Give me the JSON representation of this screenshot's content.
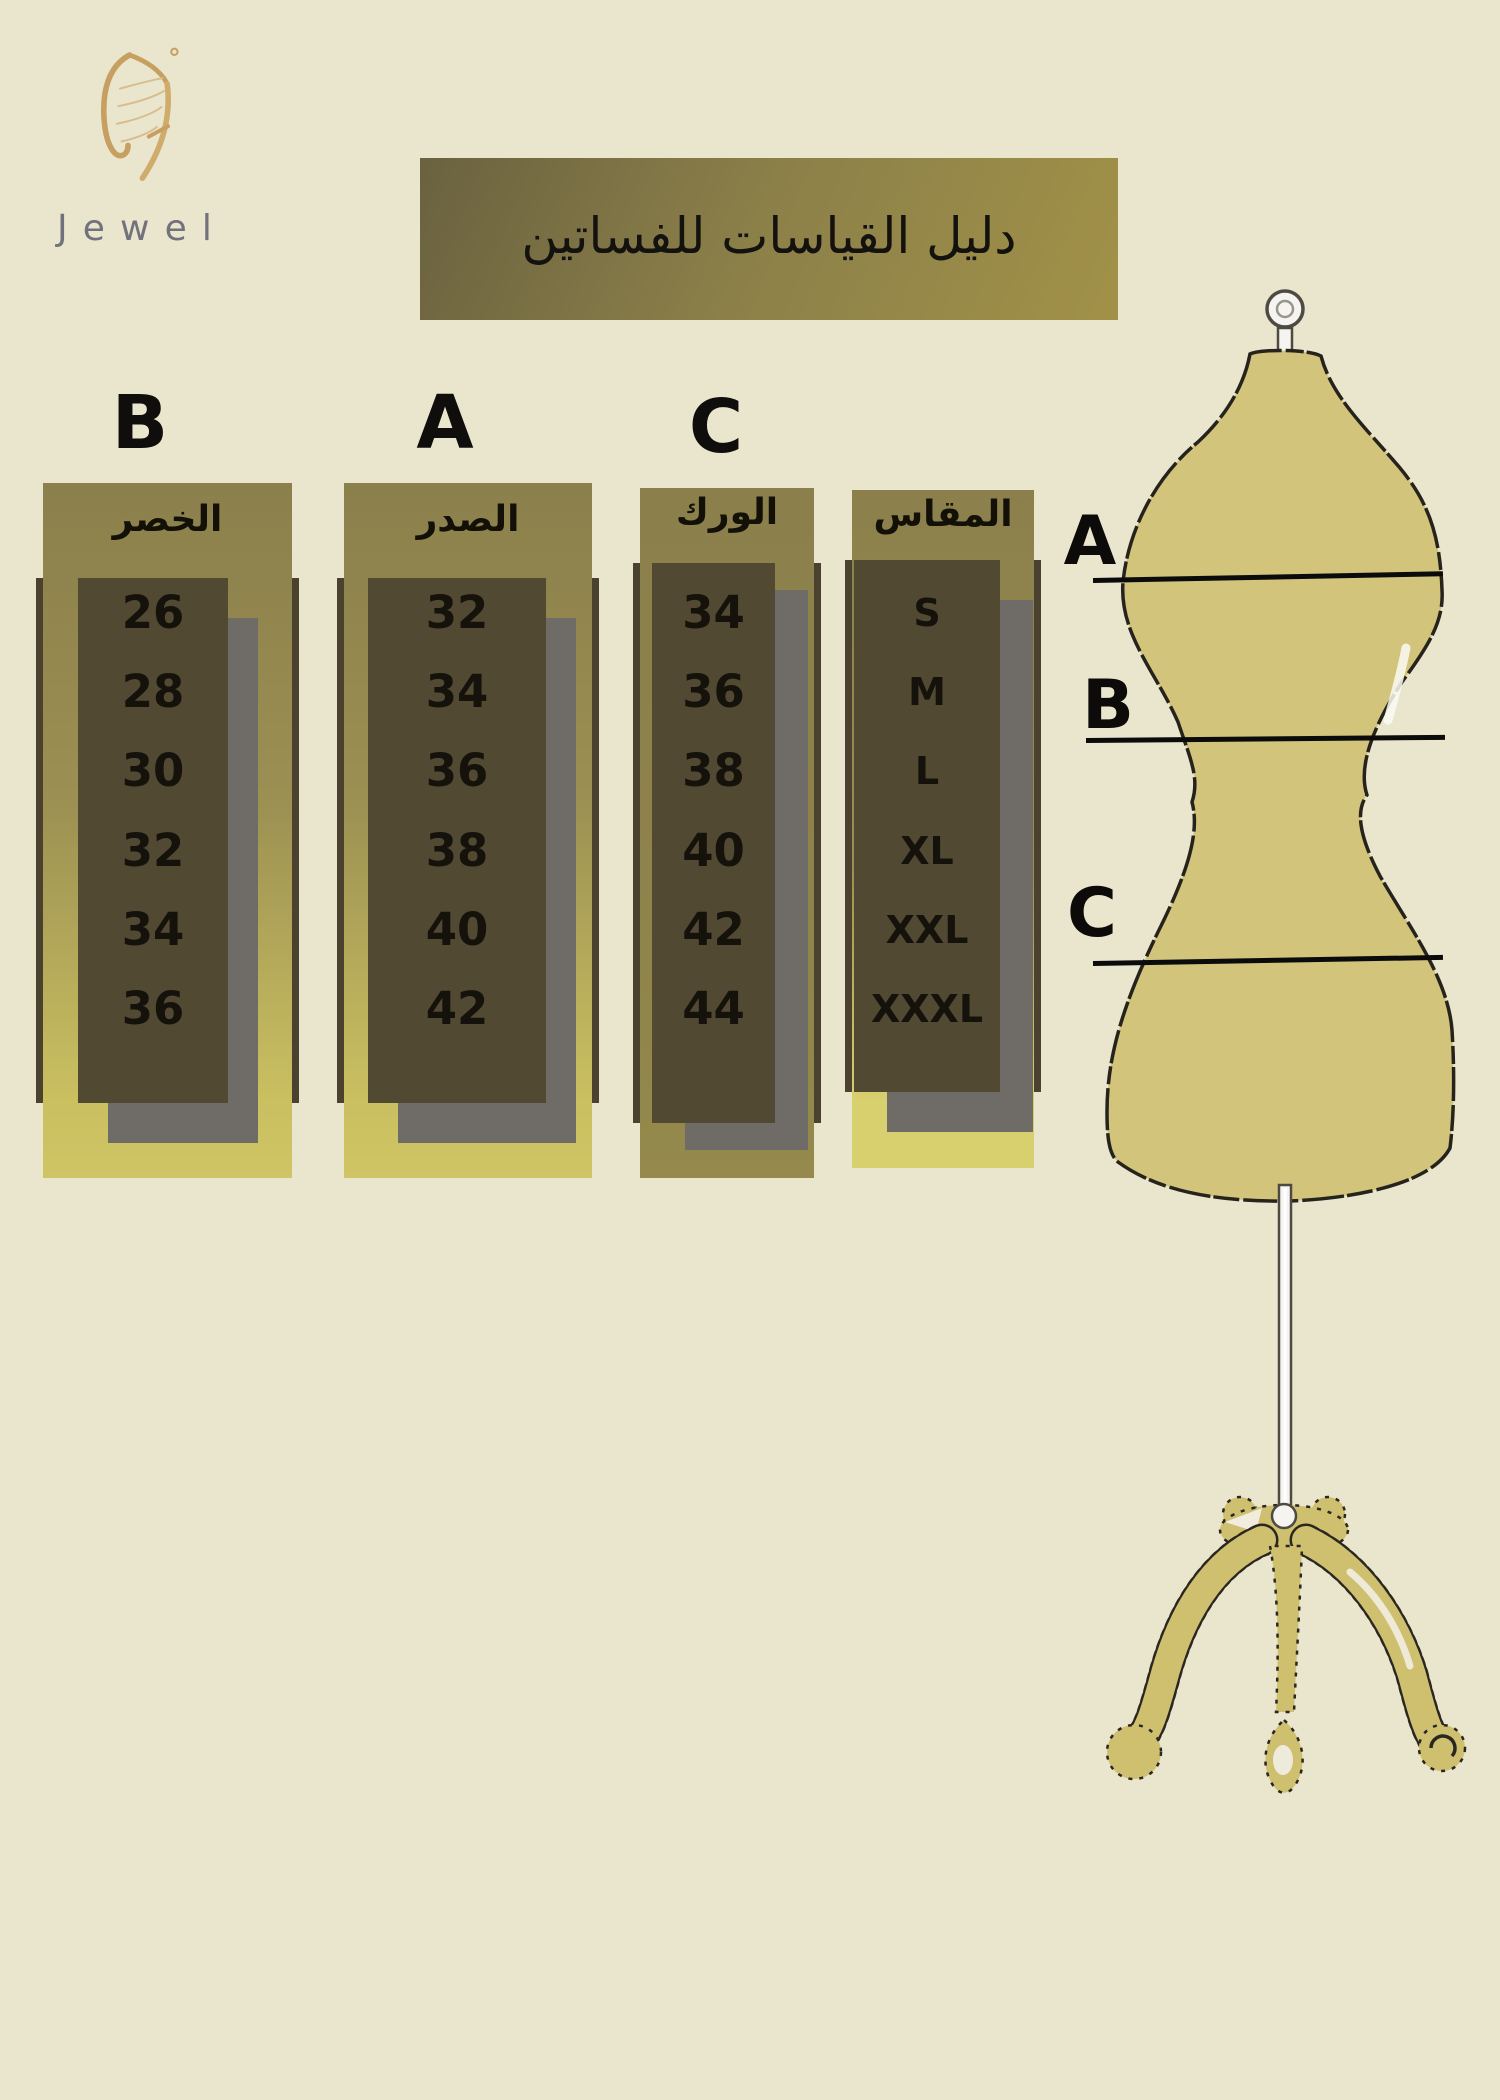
{
  "background": "#eae6ce",
  "logo": {
    "brand": "Jewel",
    "icon": "butterfly-wing-icon"
  },
  "banner": {
    "title": "دليل القياسات للفساتين"
  },
  "size_chart": {
    "columns": [
      {
        "letter": "B",
        "header": "الخصر",
        "values": [
          "26",
          "28",
          "30",
          "32",
          "34",
          "36"
        ]
      },
      {
        "letter": "A",
        "header": "الصدر",
        "values": [
          "32",
          "34",
          "36",
          "38",
          "40",
          "42"
        ]
      },
      {
        "letter": "C",
        "header": "الورك",
        "values": [
          "34",
          "36",
          "38",
          "40",
          "42",
          "44"
        ]
      },
      {
        "letter": "",
        "header": "المقاس",
        "values": [
          "S",
          "M",
          "L",
          "XL",
          "XXL",
          "XXXL"
        ]
      }
    ]
  },
  "mannequin": {
    "label_a": "A",
    "label_b": "B",
    "label_c": "C",
    "body_color": "#d3c47b"
  },
  "colors": {
    "page_background": "#eae6ce",
    "banner_from": "#6a6240",
    "banner_to": "#a19148",
    "box_gradient_top": "#8b7f4c",
    "box_gradient_bottom": "#cfc565",
    "dark_box": "#524933",
    "shadow_gray": "#6f6b67",
    "logo_gold": "#c79f60",
    "brand_gray": "#72727c"
  },
  "chart_data": {
    "type": "table",
    "title": "دليل القياسات للفساتين",
    "columns": [
      "المقاس",
      "A - الصدر",
      "B - الخصر",
      "C - الورك"
    ],
    "rows": [
      [
        "S",
        "32",
        "26",
        "34"
      ],
      [
        "M",
        "34",
        "28",
        "36"
      ],
      [
        "L",
        "36",
        "30",
        "38"
      ],
      [
        "XL",
        "38",
        "32",
        "40"
      ],
      [
        "XXL",
        "40",
        "34",
        "42"
      ],
      [
        "XXXL",
        "42",
        "36",
        "44"
      ]
    ]
  }
}
